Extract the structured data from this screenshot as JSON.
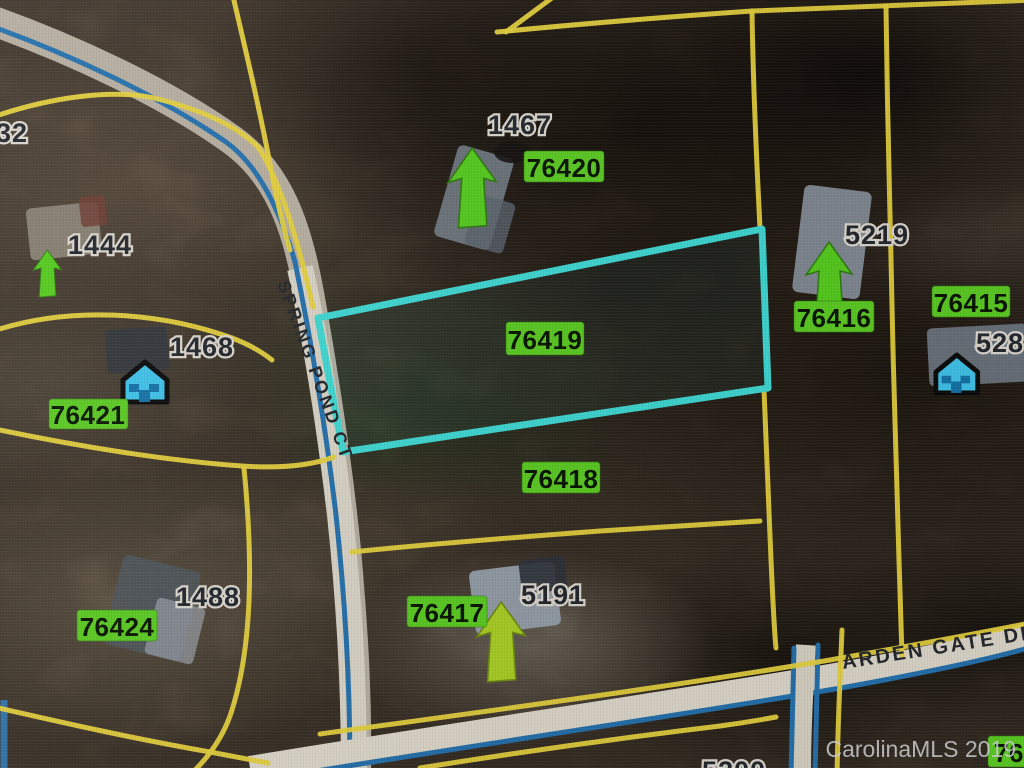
{
  "map": {
    "type": "parcel-aerial-map",
    "watermark": "CarolinaMLS 2019",
    "highlighted_parcel": "76419",
    "colors": {
      "highlight_outline": "#3fd8d3",
      "parcel_line": "#e6d13d",
      "road_line": "#2470ac",
      "parcel_label_bg": "#5bcb22",
      "parcel_label_text": "#081400"
    },
    "streets": {
      "spring_pond_ct": "SPRING POND CT",
      "arden_gate_dr": "ARDEN GATE DR"
    },
    "parcel_labels": {
      "p76420": "76420",
      "p76419": "76419",
      "p76418": "76418",
      "p76417": "76417",
      "p76416": "76416",
      "p76415": "76415",
      "p76421": "76421",
      "p76424": "76424",
      "p761_partial": "761"
    },
    "house_numbers": {
      "h1467": "1467",
      "h1444": "1444",
      "h1468": "1468",
      "h1488": "1488",
      "h5219": "5219",
      "h5191": "5191",
      "h528_partial": "528",
      "h32_partial": "32",
      "h5200_partial": "5200"
    }
  }
}
